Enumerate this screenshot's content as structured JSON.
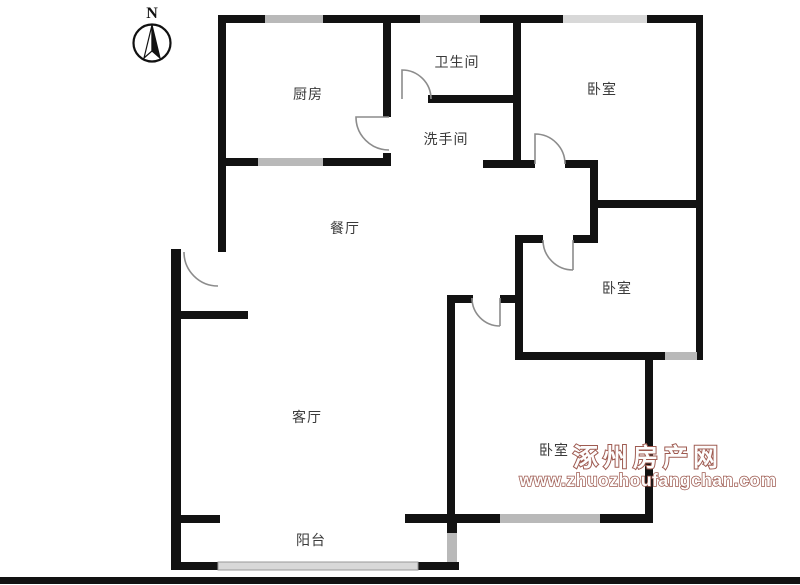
{
  "compass": {
    "label": "N"
  },
  "rooms": [
    {
      "id": "kitchen",
      "label": "厨房"
    },
    {
      "id": "bathroom",
      "label": "卫生间"
    },
    {
      "id": "washroom",
      "label": "洗手间"
    },
    {
      "id": "bedroom-north",
      "label": "卧室"
    },
    {
      "id": "dining-room",
      "label": "餐厅"
    },
    {
      "id": "bedroom-east",
      "label": "卧室"
    },
    {
      "id": "living-room",
      "label": "客厅"
    },
    {
      "id": "bedroom-south",
      "label": "卧室"
    },
    {
      "id": "balcony",
      "label": "阳台"
    }
  ],
  "watermark": {
    "site_name": "涿州房产网",
    "site_url": "www.zhuozhoufangchan.com",
    "color": "#9e5a50"
  },
  "colors": {
    "wall": "#121212",
    "window": "#b9b9b9",
    "window_light": "#d8d8d8",
    "door_arc": "#8c8c8c",
    "label": "#3a3a3a"
  }
}
